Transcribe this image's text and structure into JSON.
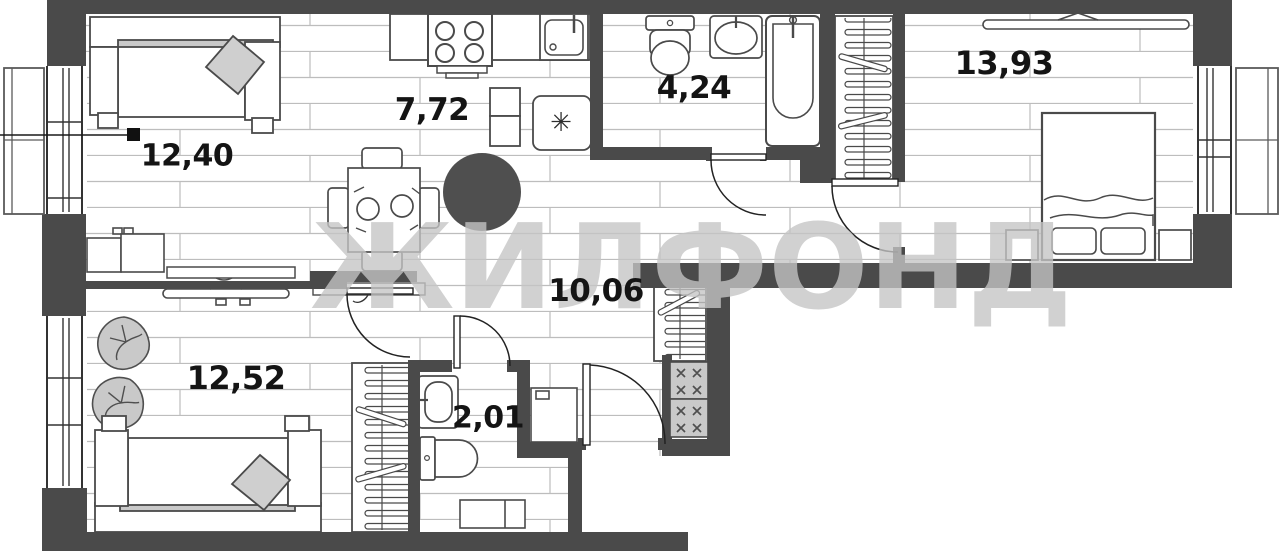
{
  "watermark": {
    "text": "ЖИЛФОНД"
  },
  "rooms": {
    "living": {
      "area": "12,40"
    },
    "kitchen": {
      "area": "7,72"
    },
    "bathroom": {
      "area": "4,24"
    },
    "bedroom": {
      "area": "13,93"
    },
    "hallway": {
      "area": "10,06"
    },
    "bedroom2": {
      "area": "12,52"
    },
    "wc": {
      "area": "2,01"
    }
  },
  "icons": {
    "fridge_snowflake": "✳"
  },
  "colors": {
    "wall": "#4a4a4a",
    "floor_line": "#bdbdbd",
    "furniture_gray": "#cccccc",
    "watermark": "#c5c5c5",
    "label_text": "#141414"
  }
}
